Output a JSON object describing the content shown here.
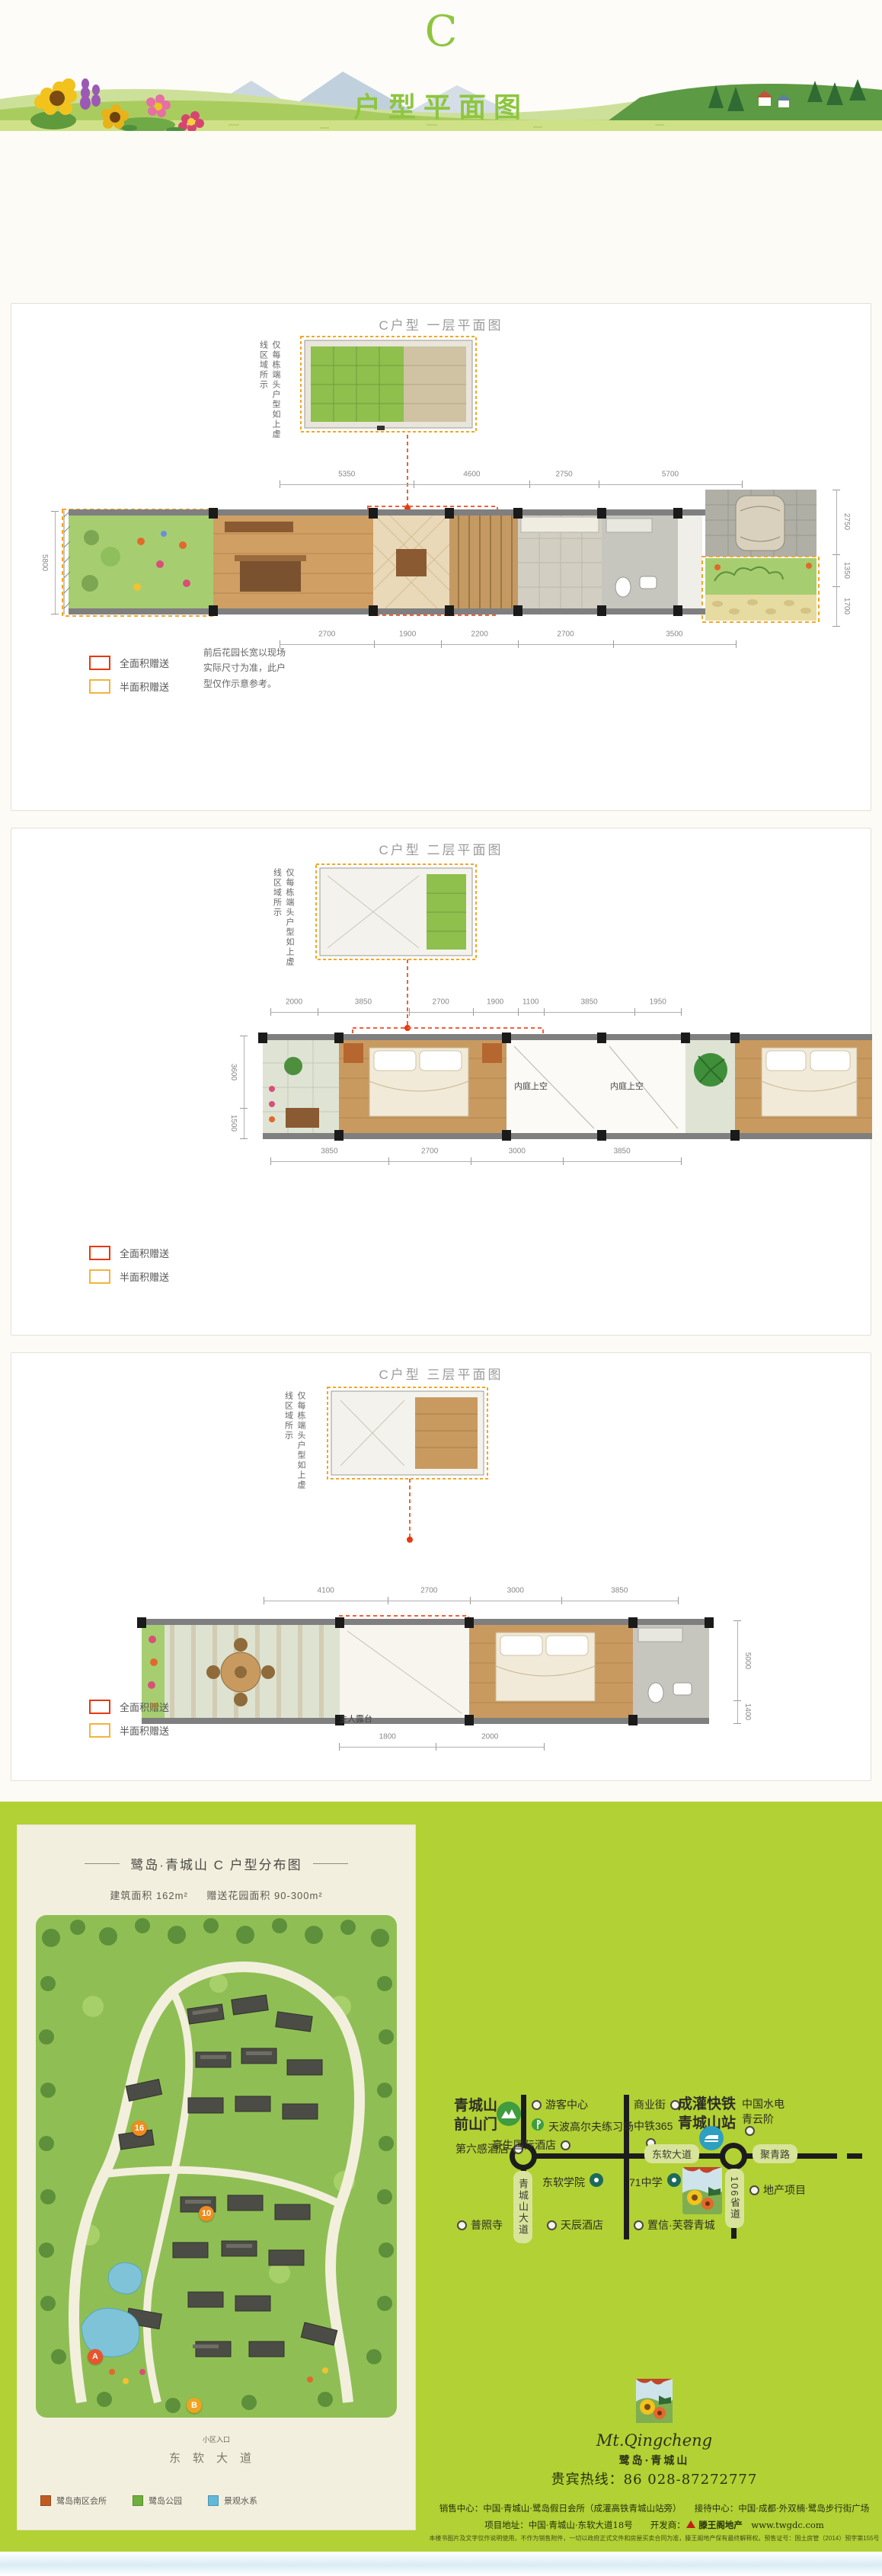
{
  "header": {
    "letter": "C",
    "title": "户型平面图"
  },
  "colors": {
    "accent_green": "#8dc63f",
    "footer_green": "#b2d134",
    "legend_full_red": "#e8380d",
    "legend_half_orange": "#f5b33c",
    "card_cream": "#f3efdf"
  },
  "panels": [
    {
      "title": "C户型 一层平面图",
      "side_note": "仅每栋端头户型如上虚线区域所示",
      "note": "前后花园长宽以现场实际尺寸为准，此户型仅作示意参考。",
      "legend_full": "全面积赠送",
      "legend_half": "半面积赠送",
      "dims_top": [
        "5350",
        "4600",
        "2750",
        "5700"
      ],
      "dims_bottom": [
        "2700",
        "1900",
        "2200",
        "2700",
        "3500"
      ],
      "dims_left": [
        "5800"
      ],
      "dims_right": [
        "2750",
        "1350",
        "1700"
      ]
    },
    {
      "title": "C户型 二层平面图",
      "side_note": "仅每栋端头户型如上虚线区域所示",
      "legend_full": "全面积赠送",
      "legend_half": "半面积赠送",
      "dims_top": [
        "2000",
        "3850",
        "2700",
        "1900",
        "1100",
        "3850",
        "1950"
      ],
      "dims_bottom": [
        "3850",
        "2700",
        "3000",
        "3850"
      ],
      "dims_left": [
        "3600",
        "1500"
      ],
      "rooms": [
        "内庭上空",
        "内庭上空"
      ]
    },
    {
      "title": "C户型 三层平面图",
      "side_note": "仅每栋端头户型如上虚线区域所示",
      "legend_full": "全面积赠送",
      "legend_half": "半面积赠送",
      "dims_top": [
        "4100",
        "2700",
        "3000",
        "3850"
      ],
      "dims_bottom": [
        "1800",
        "2000"
      ],
      "dims_right": [
        "5000",
        "1400"
      ],
      "rooms": [
        "主人露台"
      ]
    }
  ],
  "footer": {
    "siteplan": {
      "title": "鹭岛·青城山  C 户型分布图",
      "area1": "建筑面积  162m²",
      "area2": "赠送花园面积  90-300m²",
      "entrance": "小区入口",
      "road": "东软大道",
      "markers": [
        "16",
        "10",
        "A",
        "B"
      ],
      "legend": [
        {
          "label": "鹭岛南区会所"
        },
        {
          "label": "鹭岛公园"
        },
        {
          "label": "景观水系"
        }
      ]
    },
    "map": {
      "gate": "青城山前山门",
      "sixth_hotel": "第六感酒店",
      "visitor_center": "游客中心",
      "golf": "天波高尔夫练习场",
      "howard": "豪生国际酒店",
      "biz_street": "商业街",
      "zhongtie365": "中铁365",
      "rail_station": "成灌快铁青城山站",
      "hydro": "中国水电青云阶",
      "neusoft": "东软学院",
      "school71": "71中学",
      "estate": "地产项目",
      "puzhao": "普照寺",
      "tianchen": "天辰酒店",
      "zhixin": "置信·芙蓉青城",
      "road_dongruan": "东软大道",
      "road_juqing": "聚青路",
      "road_qcs": "青城山大道",
      "road_106": "106省道"
    },
    "logo": {
      "script": "Mt.Qingcheng",
      "name": "鹭岛·青城山"
    },
    "hotline": "贵宾热线：86 028-87272777",
    "contact1": "销售中心：中国·青城山·鹭岛假日会所（成灌高铁青城山站旁）　　接待中心：中国·成都·外双楠·鹭岛步行街广场",
    "contact2_addr": "项目地址：中国·青城山·东软大道18号　　开发商：",
    "developer": "滕王阁地产",
    "website": "www.twgdc.com",
    "disclaimer": "本楼书图片及文字仅作说明使用，不作为销售附件，一切以政府正式文件和房屋买卖合同为准，滕王阁地产保有最终解释权。预售证号：国土房管（2014）预字第155号"
  }
}
